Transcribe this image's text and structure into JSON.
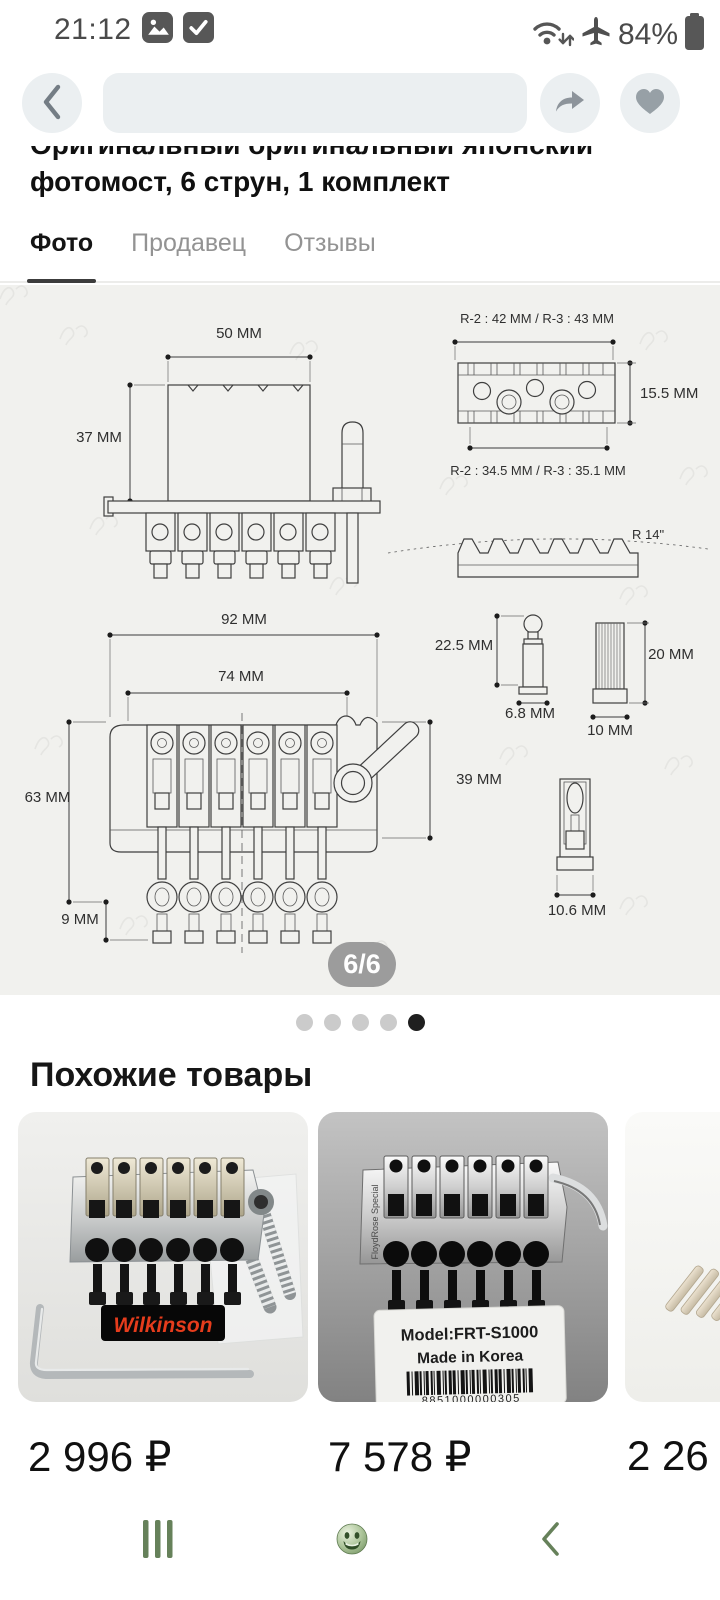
{
  "status_bar": {
    "time": "21:12",
    "battery": "84%"
  },
  "product": {
    "title_line1": "Оригинальный оригинальный японский",
    "title_line2": "фотомост, 6 струн, 1 комплект"
  },
  "tabs": [
    {
      "label": "Фото",
      "active": true
    },
    {
      "label": "Продавец",
      "active": false
    },
    {
      "label": "Отзывы",
      "active": false
    }
  ],
  "image_viewer": {
    "counter": "6/6",
    "total_dots": 5,
    "active_dot_index": 4
  },
  "drawing": {
    "side_view": {
      "width": "50 MM",
      "height": "37 MM"
    },
    "locking_nut": {
      "top_width": "R-2 : 42 MM / R-3 : 43 MM",
      "height": "15.5 MM",
      "bottom_width": "R-2 : 34.5 MM / R-3 : 35.1 MM",
      "fret_radius": "R 14\""
    },
    "top_view": {
      "width": "92 MM",
      "screw_spacing": "74 MM",
      "length": "63 MM",
      "tuner_offset": "9 MM",
      "depth": "39 MM"
    },
    "stud": {
      "height": "22.5 MM",
      "diameter": "6.8 MM"
    },
    "insert": {
      "height": "20 MM",
      "diameter": "10 MM"
    },
    "saddle": {
      "width": "10.6 MM"
    }
  },
  "similar": {
    "heading": "Похожие товары",
    "products": [
      {
        "price": "2 996 ₽",
        "brand": "Wilkinson"
      },
      {
        "price": "7 578 ₽",
        "side_text": "FloydRose Special",
        "model": "Model:FRT-S1000",
        "origin": "Made in Korea",
        "barcode_number": "8851000000305"
      },
      {
        "price": "2 26"
      }
    ]
  },
  "colors": {
    "bottom_nav_green": "#66815a",
    "badge_bg": "#9c9c9c",
    "wilkinson_red": "#e63c1c",
    "button_bg": "#ebeff1"
  }
}
